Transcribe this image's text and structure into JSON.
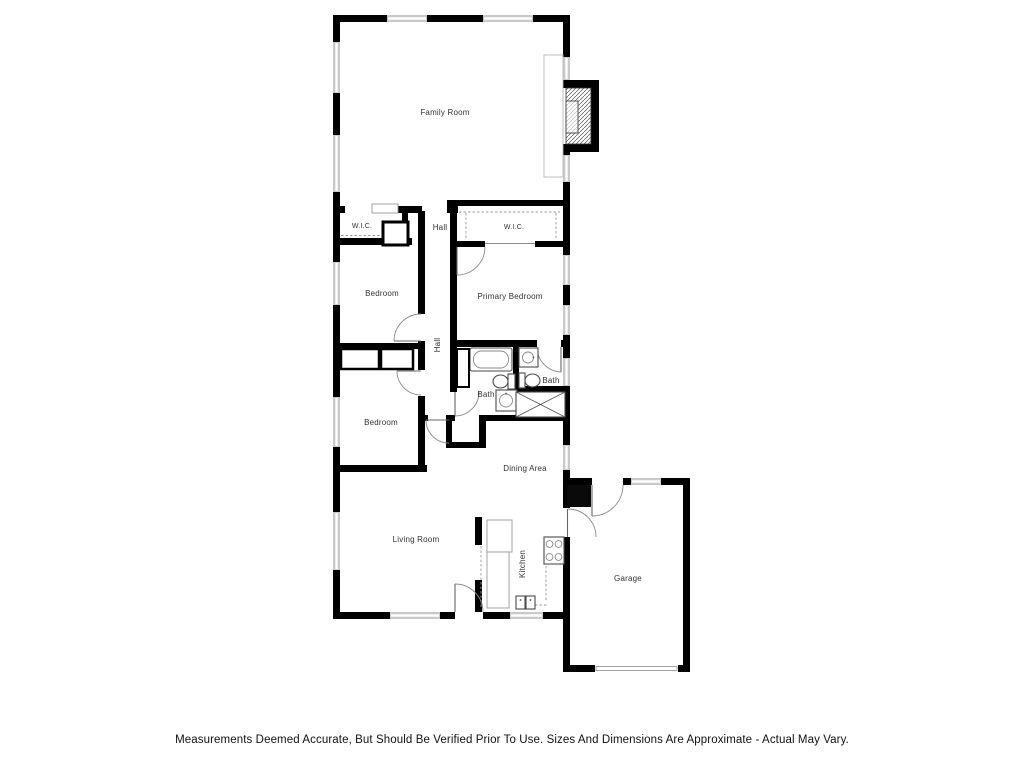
{
  "page": {
    "background": "#ffffff",
    "disclaimer": "Measurements Deemed Accurate, But Should Be Verified Prior To Use. Sizes And Dimensions Are Approximate - Actual May Vary."
  },
  "floorplan": {
    "colors": {
      "wall": "#000000",
      "window": "#c9c9c9",
      "thin_line": "#9a9a9a",
      "fixture_line": "#4a4a4a",
      "label_text": "#333333"
    },
    "labels": {
      "family_room": "Family Room",
      "wic_left": "W.I.C.",
      "hall_upper": "Hall",
      "wic_right": "W.I.C.",
      "bedroom_1": "Bedroom",
      "primary_bedroom": "Primary Bedroom",
      "hall_vertical": "Hall",
      "bath_primary": "Bath",
      "bath_hall": "Bath",
      "bedroom_2": "Bedroom",
      "dining_area": "Dining Area",
      "living_room": "Living Room",
      "kitchen": "Kitchen",
      "garage": "Garage"
    }
  }
}
